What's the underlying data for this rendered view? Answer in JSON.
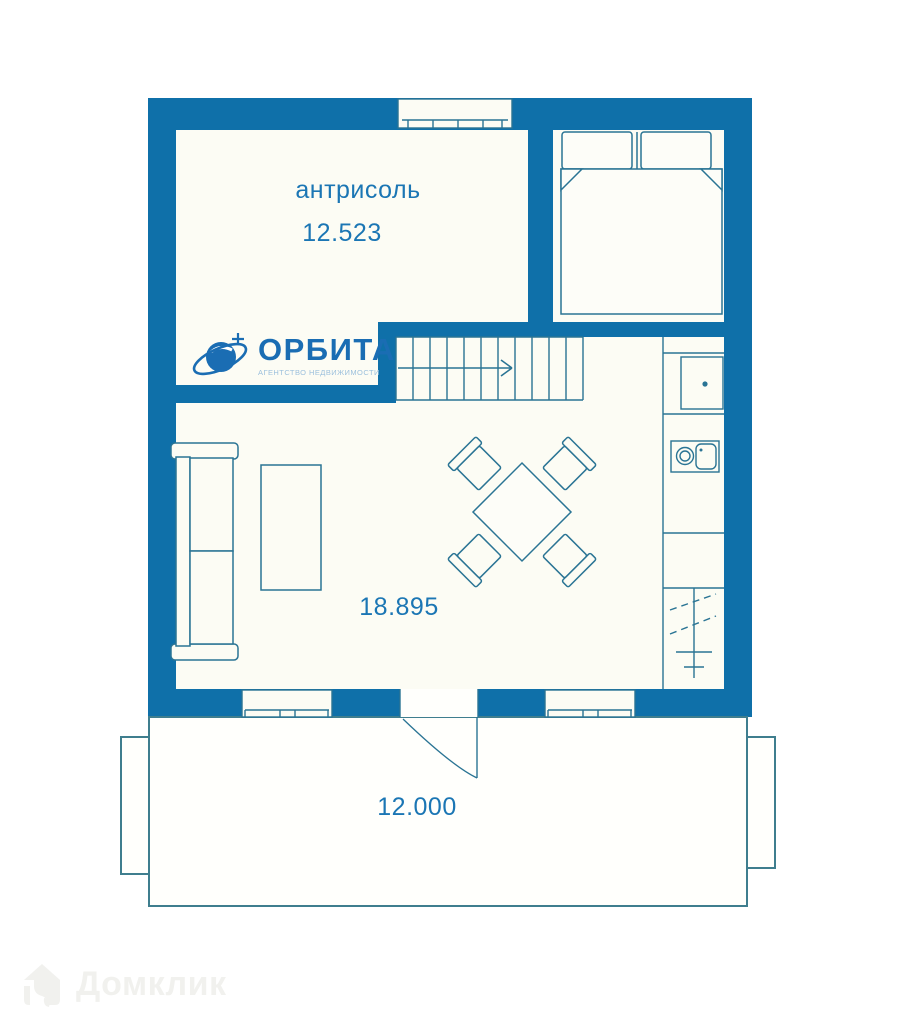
{
  "colors": {
    "wall": "#0f70a9",
    "furniture_line": "#2a7494",
    "room_fill": "#fcfcf4",
    "terrace_line": "#3f7e8e",
    "label_text": "#1b76b4",
    "logo_blue": "#1a6db3",
    "logo_tagline_blue": "#9cc0dd",
    "watermark_gray": "#f1f1ee"
  },
  "rooms": {
    "mezzanine": {
      "label": "антрисоль",
      "area": "12.523"
    },
    "living": {
      "area": "18.895"
    },
    "terrace": {
      "area": "12.000"
    }
  },
  "logo": {
    "title": "ОРБИТА",
    "tagline": "АГЕНТСТВО НЕДВИЖИМОСТИ"
  },
  "watermark": {
    "label": "Домклик"
  }
}
